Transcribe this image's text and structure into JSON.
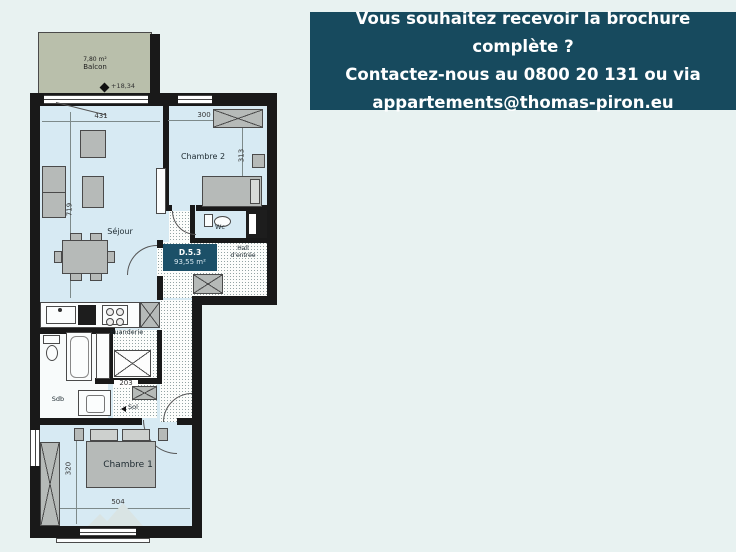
{
  "banner": {
    "line1": "Vous souhaitez recevoir la brochure complète ?",
    "line2": "Contactez-nous au 0800 20 131 ou via",
    "line3": "appartements@thomas-piron.eu"
  },
  "plan": {
    "unit_id": "D.5.3",
    "unit_area": "93,55 m²",
    "level": "+18,34",
    "balcony_area": "7,80 m²",
    "rooms": {
      "balcon": "Balcon",
      "sejour": "Séjour",
      "chambre2": "Chambre 2",
      "wc": "Wc",
      "hall_line1": "Hall",
      "hall_line2": "d'entrée",
      "buanderie": "Buanderie",
      "sdb": "Sdb",
      "sol": "Sol",
      "chambre1": "Chambre 1"
    },
    "dims": {
      "d431": "431",
      "d300": "300",
      "d313": "313",
      "d719": "719",
      "d203": "203",
      "d320": "320",
      "d504": "504"
    },
    "colors": {
      "banner_bg": "#174a5e",
      "wall": "#191919",
      "room_fill": "#d7eaf3",
      "balcony_fill": "#b9bfab",
      "accent_box": "#1c5068",
      "page_bg": "#e8f2f1"
    }
  }
}
